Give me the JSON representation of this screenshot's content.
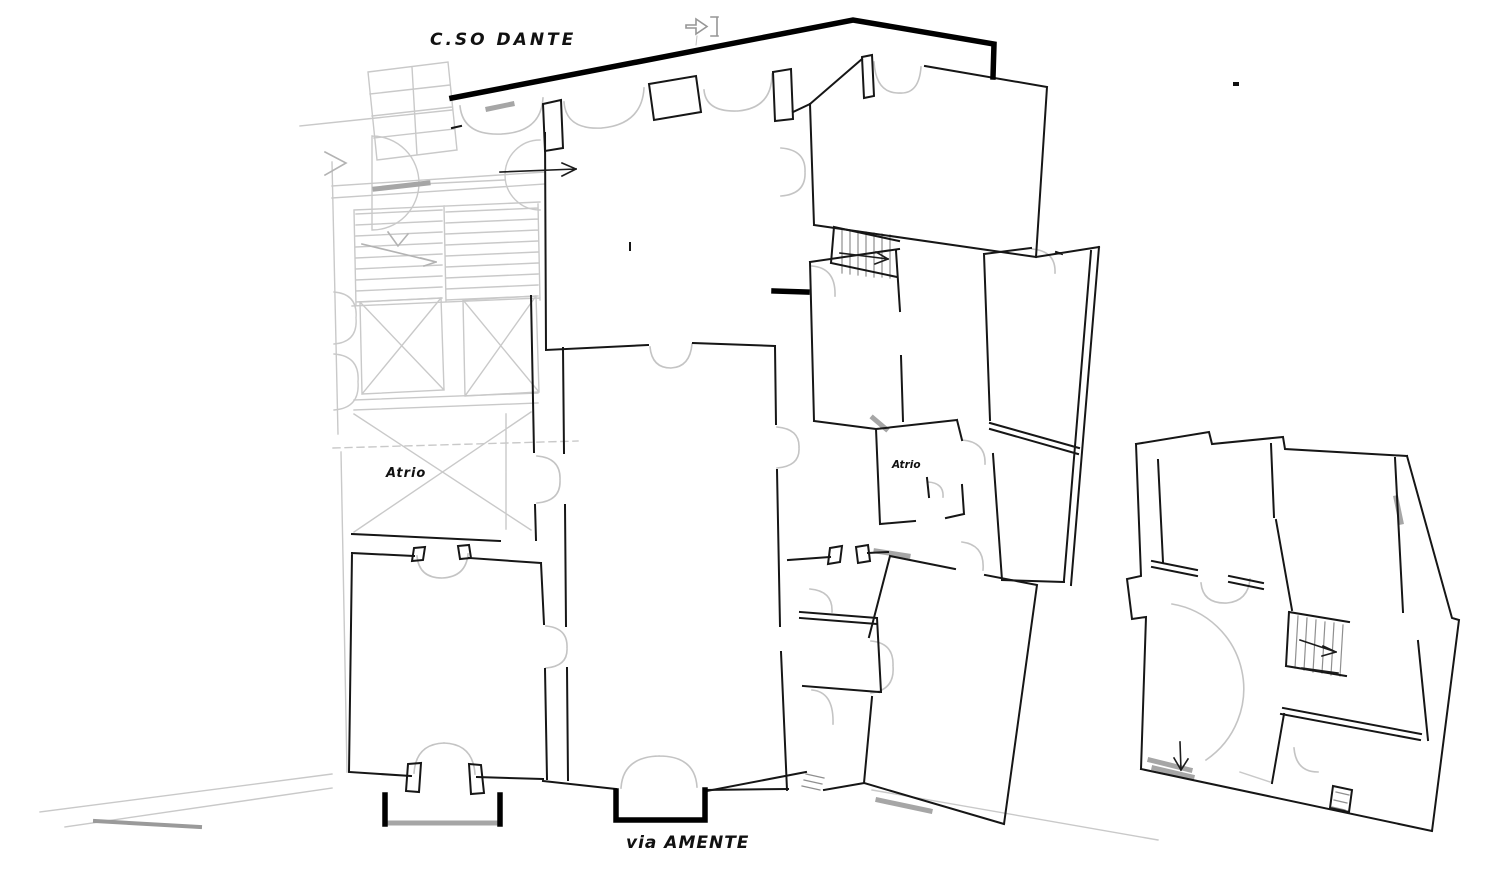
{
  "labels": {
    "street_top": "C.SO DANTE",
    "street_bottom": "via AMENTE",
    "atrio_left": "Atrio",
    "atrio_right": "Atrio"
  },
  "colors": {
    "background": "#ffffff",
    "wall": "#161616",
    "thick_wall": "#000000",
    "faded": "#c9c9c9",
    "arc": "#c4c4c4",
    "sill": "#a6a6a6",
    "text": "#111111"
  },
  "icons": {
    "cad_cursor": "right-block-arrow-with-bracket",
    "room_flow_arrow": "right-arrow",
    "stair_up_arrow_right_wing": "right-arrow",
    "stair_arrow_detached": "down-right-arrow",
    "exit_arrow_detached": "down-arrow",
    "stair_direction_gray": "down-right-arrow"
  }
}
